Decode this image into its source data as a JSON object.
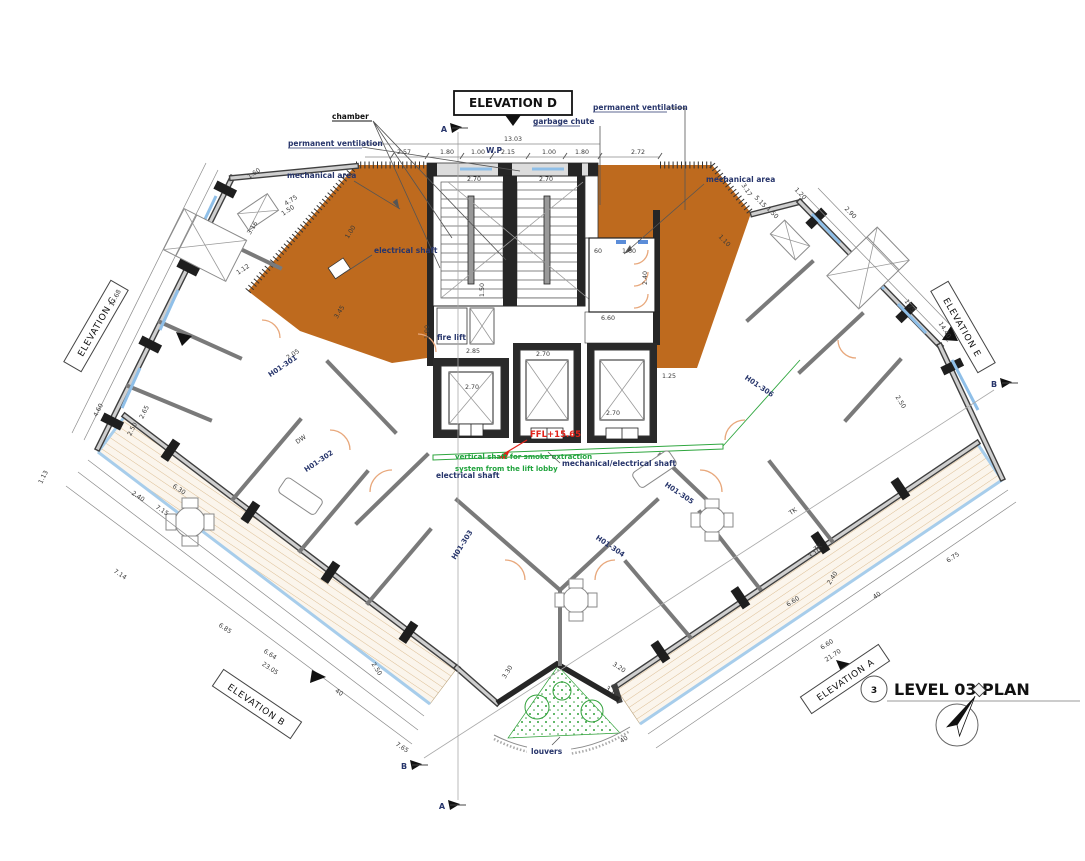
{
  "title": {
    "number": "3",
    "text": "LEVEL 03 PLAN"
  },
  "labels": {
    "elevation_d": "ELEVATION D",
    "chamber": "chamber",
    "permanent_ventilation_left": "permanent ventilation",
    "permanent_ventilation_right": "permanent ventilation",
    "garbage_chute": "garbage chute",
    "wp": "W.P",
    "mechanical_area_left": "mechanical area",
    "mechanical_area_right": "mechanical area",
    "electrical_shaft_mech": "electrical shaft",
    "fire_lift": "fire lift",
    "ffl": "FFL+15.65",
    "smoke_shaft_1": "vertical shaft for smoke extraction",
    "smoke_shaft_2": "system from the lift lobby",
    "electrical_shaft_lobby": "electrical shaft",
    "mech_elec_shaft": "mechanical/electrical shaft",
    "louvers": "louvers"
  },
  "units": [
    {
      "label": "H01-301",
      "x": 284,
      "y": 368,
      "r": -34
    },
    {
      "label": "H01-302",
      "x": 320,
      "y": 463,
      "r": -34
    },
    {
      "label": "H01-303",
      "x": 464,
      "y": 546,
      "r": -58
    },
    {
      "label": "H01-304",
      "x": 609,
      "y": 548,
      "r": 34
    },
    {
      "label": "H01-305",
      "x": 678,
      "y": 495,
      "r": 34
    },
    {
      "label": "H01-306",
      "x": 758,
      "y": 388,
      "r": 34
    }
  ],
  "elevation_tags": [
    {
      "label": "ELEVATION C",
      "x": 96,
      "y": 326,
      "r": -60
    },
    {
      "label": "ELEVATION E",
      "x": 963,
      "y": 327,
      "r": 60
    },
    {
      "label": "ELEVATION B",
      "x": 257,
      "y": 704,
      "r": 34
    },
    {
      "label": "ELEVATION A",
      "x": 845,
      "y": 679,
      "r": -34
    }
  ],
  "section_markers": [
    {
      "letter": "A",
      "x": 444,
      "y": 129
    },
    {
      "letter": "A",
      "x": 442,
      "y": 806
    },
    {
      "letter": "B",
      "x": 994,
      "y": 384
    },
    {
      "letter": "B",
      "x": 404,
      "y": 766
    }
  ],
  "dimensions": [
    {
      "t": "13.03",
      "x": 513,
      "y": 141,
      "r": 0
    },
    {
      "t": "2.57",
      "x": 404,
      "y": 154,
      "r": 0
    },
    {
      "t": "1.80",
      "x": 447,
      "y": 154,
      "r": 0
    },
    {
      "t": "1.00",
      "x": 478,
      "y": 154,
      "r": 0
    },
    {
      "t": "2.15",
      "x": 508,
      "y": 154,
      "r": 0
    },
    {
      "t": "1.00",
      "x": 549,
      "y": 154,
      "r": 0
    },
    {
      "t": "1.80",
      "x": 582,
      "y": 154,
      "r": 0
    },
    {
      "t": "2.72",
      "x": 638,
      "y": 154,
      "r": 0
    },
    {
      "t": "2.70",
      "x": 474,
      "y": 181,
      "r": 0
    },
    {
      "t": "2.70",
      "x": 546,
      "y": 181,
      "r": 0
    },
    {
      "t": "1.50",
      "x": 484,
      "y": 290,
      "r": -90
    },
    {
      "t": "60",
      "x": 598,
      "y": 253,
      "r": 0
    },
    {
      "t": "1.60",
      "x": 629,
      "y": 253,
      "r": 0
    },
    {
      "t": "2.40",
      "x": 647,
      "y": 278,
      "r": -90
    },
    {
      "t": "6.60",
      "x": 608,
      "y": 320,
      "r": 0
    },
    {
      "t": "2.85",
      "x": 473,
      "y": 353,
      "r": 0
    },
    {
      "t": "2.70",
      "x": 543,
      "y": 356,
      "r": 0
    },
    {
      "t": "2.70",
      "x": 472,
      "y": 389,
      "r": 0
    },
    {
      "t": "2.70",
      "x": 613,
      "y": 415,
      "r": 0
    },
    {
      "t": "1.25",
      "x": 669,
      "y": 378,
      "r": 0
    },
    {
      "t": "1.90",
      "x": 429,
      "y": 332,
      "r": -90
    },
    {
      "t": "3.45",
      "x": 341,
      "y": 313,
      "r": -58
    },
    {
      "t": "1.00",
      "x": 352,
      "y": 233,
      "r": -58
    },
    {
      "t": "17.68",
      "x": 117,
      "y": 299,
      "r": -63
    },
    {
      "t": "4.60",
      "x": 100,
      "y": 411,
      "r": -63
    },
    {
      "t": "2.65",
      "x": 146,
      "y": 413,
      "r": -63
    },
    {
      "t": "2.50",
      "x": 134,
      "y": 430,
      "r": -63
    },
    {
      "t": "1.13",
      "x": 45,
      "y": 478,
      "r": -63
    },
    {
      "t": "1.60",
      "x": 255,
      "y": 175,
      "r": -34
    },
    {
      "t": "4.75",
      "x": 292,
      "y": 202,
      "r": -34
    },
    {
      "t": "1.50",
      "x": 289,
      "y": 212,
      "r": -34
    },
    {
      "t": "3.16",
      "x": 254,
      "y": 229,
      "r": -58
    },
    {
      "t": "1.12",
      "x": 244,
      "y": 271,
      "r": -34
    },
    {
      "t": "2.05",
      "x": 294,
      "y": 356,
      "r": -34
    },
    {
      "t": "DW",
      "x": 302,
      "y": 441,
      "r": -34
    },
    {
      "t": "6.30",
      "x": 178,
      "y": 491,
      "r": 34
    },
    {
      "t": "2.40",
      "x": 137,
      "y": 498,
      "r": 34
    },
    {
      "t": "7.15",
      "x": 161,
      "y": 512,
      "r": 34
    },
    {
      "t": "7.14",
      "x": 119,
      "y": 576,
      "r": 34
    },
    {
      "t": "6.85",
      "x": 224,
      "y": 630,
      "r": 34
    },
    {
      "t": "6.64",
      "x": 269,
      "y": 656,
      "r": 34
    },
    {
      "t": "23.05",
      "x": 269,
      "y": 670,
      "r": 34
    },
    {
      "t": "40",
      "x": 338,
      "y": 694,
      "r": 34
    },
    {
      "t": "2.50",
      "x": 375,
      "y": 670,
      "r": 58
    },
    {
      "t": "7.65",
      "x": 401,
      "y": 749,
      "r": 34
    },
    {
      "t": "3.30",
      "x": 509,
      "y": 673,
      "r": -58
    },
    {
      "t": "3.20",
      "x": 618,
      "y": 669,
      "r": 34
    },
    {
      "t": "3.10",
      "x": 611,
      "y": 693,
      "r": 34
    },
    {
      "t": "40",
      "x": 625,
      "y": 741,
      "r": -34
    },
    {
      "t": "6.75",
      "x": 954,
      "y": 559,
      "r": -34
    },
    {
      "t": "6.60",
      "x": 794,
      "y": 603,
      "r": -34
    },
    {
      "t": "6.60",
      "x": 828,
      "y": 646,
      "r": -34
    },
    {
      "t": "21.70",
      "x": 834,
      "y": 657,
      "r": -34
    },
    {
      "t": "40",
      "x": 878,
      "y": 597,
      "r": -34
    },
    {
      "t": "2.40",
      "x": 834,
      "y": 579,
      "r": -58
    },
    {
      "t": "3.10",
      "x": 816,
      "y": 555,
      "r": -34
    },
    {
      "t": "TK",
      "x": 794,
      "y": 513,
      "r": -34
    },
    {
      "t": "TK",
      "x": 819,
      "y": 549,
      "r": -34
    },
    {
      "t": "14.40",
      "x": 943,
      "y": 331,
      "r": 58
    },
    {
      "t": "1.75",
      "x": 908,
      "y": 307,
      "r": 58
    },
    {
      "t": "2.50",
      "x": 899,
      "y": 403,
      "r": 58
    },
    {
      "t": "3.17",
      "x": 745,
      "y": 191,
      "r": 58
    },
    {
      "t": "5.15",
      "x": 759,
      "y": 203,
      "r": 46
    },
    {
      "t": "1.50",
      "x": 771,
      "y": 214,
      "r": 46
    },
    {
      "t": "1.20",
      "x": 799,
      "y": 195,
      "r": 46
    },
    {
      "t": "2.90",
      "x": 849,
      "y": 214,
      "r": 46
    },
    {
      "t": "1.10",
      "x": 723,
      "y": 242,
      "r": 46
    }
  ],
  "colors": {
    "mechanical_area": "#BE6A1E",
    "balcony_hatch": "#DCBE94",
    "glazing": "#8FBFE8",
    "annotation_navy": "#27356B",
    "plan_green": "#1FA33C",
    "ffl_red": "#E2231A",
    "wall_dark": "#262626"
  }
}
